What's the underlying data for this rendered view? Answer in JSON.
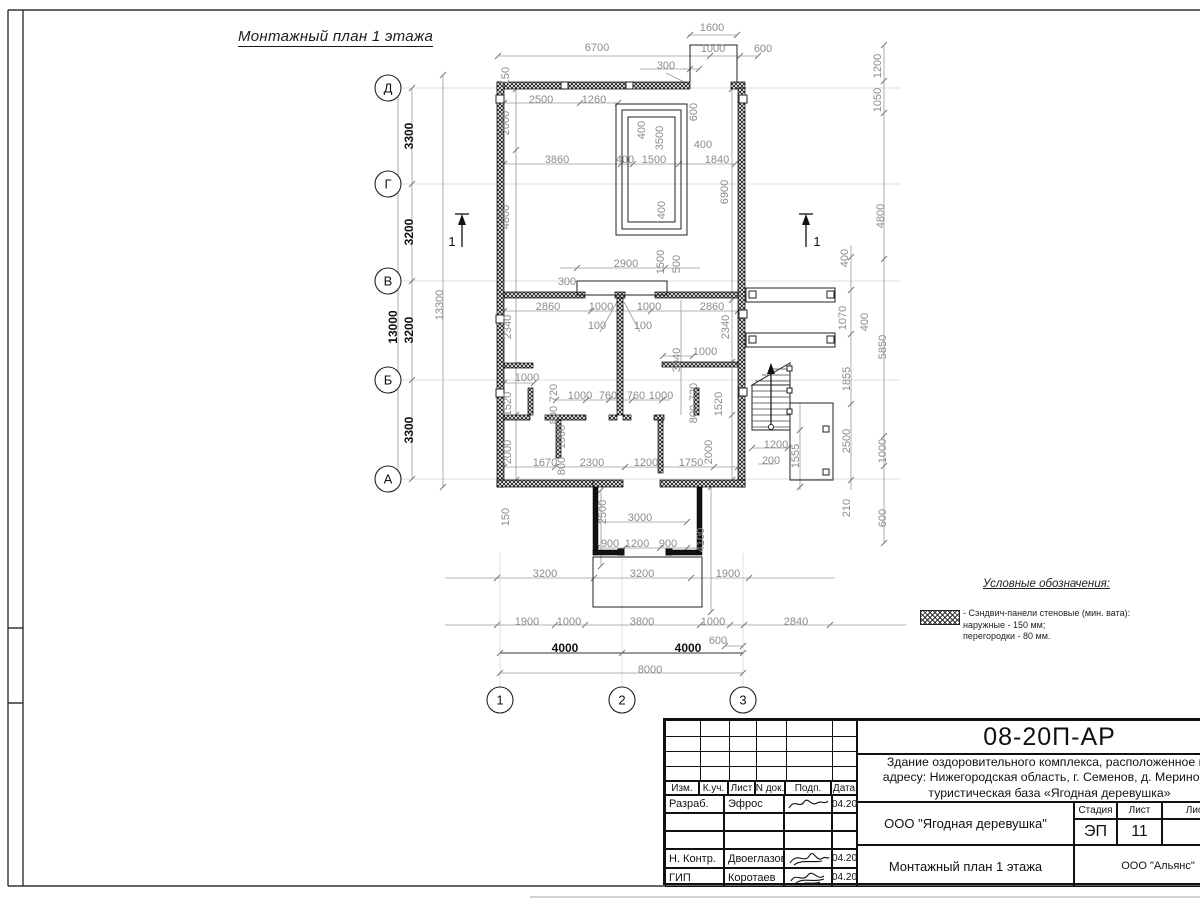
{
  "sheet": {
    "title": "Монтажный план 1 этажа"
  },
  "sections": [
    {
      "label": "1"
    },
    {
      "label": "1"
    }
  ],
  "axes": {
    "rows": [
      {
        "label": "Д",
        "y": 88
      },
      {
        "label": "Г",
        "y": 184
      },
      {
        "label": "В",
        "y": 281
      },
      {
        "label": "Б",
        "y": 380
      },
      {
        "label": "А",
        "y": 479
      }
    ],
    "cols": [
      {
        "label": "1",
        "x": 500
      },
      {
        "label": "2",
        "x": 622
      },
      {
        "label": "3",
        "x": 743
      }
    ]
  },
  "dimensions": [
    {
      "t": "1600",
      "x": 712,
      "y": 31,
      "o": "h"
    },
    {
      "t": "6700",
      "x": 597,
      "y": 51,
      "o": "h"
    },
    {
      "t": "1000",
      "x": 713,
      "y": 52,
      "o": "h"
    },
    {
      "t": "600",
      "x": 763,
      "y": 52,
      "o": "h"
    },
    {
      "t": "300",
      "x": 666,
      "y": 69,
      "o": "h"
    },
    {
      "t": "150",
      "x": 509,
      "y": 76,
      "o": "v"
    },
    {
      "t": "2500",
      "x": 541,
      "y": 103,
      "o": "h"
    },
    {
      "t": "1260",
      "x": 594,
      "y": 103,
      "o": "h"
    },
    {
      "t": "2000",
      "x": 509,
      "y": 123,
      "o": "v"
    },
    {
      "t": "600",
      "x": 697,
      "y": 112,
      "o": "v"
    },
    {
      "t": "400",
      "x": 645,
      "y": 130,
      "o": "v"
    },
    {
      "t": "3500",
      "x": 663,
      "y": 138,
      "o": "v"
    },
    {
      "t": "3860",
      "x": 557,
      "y": 163,
      "o": "h"
    },
    {
      "t": "400",
      "x": 625,
      "y": 163,
      "o": "h"
    },
    {
      "t": "1500",
      "x": 654,
      "y": 163,
      "o": "h"
    },
    {
      "t": "400",
      "x": 703,
      "y": 148,
      "o": "h"
    },
    {
      "t": "1840",
      "x": 717,
      "y": 163,
      "o": "h"
    },
    {
      "t": "6900",
      "x": 728,
      "y": 192,
      "o": "v"
    },
    {
      "t": "4800",
      "x": 509,
      "y": 217,
      "o": "v"
    },
    {
      "t": "400",
      "x": 665,
      "y": 210,
      "o": "v"
    },
    {
      "t": "1200",
      "x": 881,
      "y": 66,
      "o": "v"
    },
    {
      "t": "1050",
      "x": 881,
      "y": 100,
      "o": "v"
    },
    {
      "t": "4800",
      "x": 884,
      "y": 216,
      "o": "v"
    },
    {
      "t": "2900",
      "x": 626,
      "y": 267,
      "o": "h"
    },
    {
      "t": "300",
      "x": 567,
      "y": 285,
      "o": "h"
    },
    {
      "t": "1500",
      "x": 664,
      "y": 262,
      "o": "v"
    },
    {
      "t": "500",
      "x": 680,
      "y": 264,
      "o": "v"
    },
    {
      "t": "2860",
      "x": 548,
      "y": 310,
      "o": "h"
    },
    {
      "t": "1000",
      "x": 601,
      "y": 310,
      "o": "h"
    },
    {
      "t": "1000",
      "x": 649,
      "y": 310,
      "o": "h"
    },
    {
      "t": "2860",
      "x": 712,
      "y": 310,
      "o": "h"
    },
    {
      "t": "100",
      "x": 597,
      "y": 329,
      "o": "h"
    },
    {
      "t": "100",
      "x": 643,
      "y": 329,
      "o": "h"
    },
    {
      "t": "2340",
      "x": 511,
      "y": 327,
      "o": "v"
    },
    {
      "t": "2340",
      "x": 729,
      "y": 327,
      "o": "v"
    },
    {
      "t": "3940",
      "x": 680,
      "y": 360,
      "o": "v"
    },
    {
      "t": "1000",
      "x": 705,
      "y": 355,
      "o": "h"
    },
    {
      "t": "1000",
      "x": 527,
      "y": 381,
      "o": "h"
    },
    {
      "t": "400",
      "x": 848,
      "y": 258,
      "o": "v"
    },
    {
      "t": "1070",
      "x": 846,
      "y": 318,
      "o": "v"
    },
    {
      "t": "400",
      "x": 868,
      "y": 322,
      "o": "v"
    },
    {
      "t": "5850",
      "x": 886,
      "y": 347,
      "o": "v"
    },
    {
      "t": "1855",
      "x": 850,
      "y": 379,
      "o": "v"
    },
    {
      "t": "2500",
      "x": 850,
      "y": 441,
      "o": "v"
    },
    {
      "t": "1000",
      "x": 886,
      "y": 451,
      "o": "v"
    },
    {
      "t": "210",
      "x": 850,
      "y": 508,
      "o": "v"
    },
    {
      "t": "600",
      "x": 886,
      "y": 518,
      "o": "v"
    },
    {
      "t": "1200",
      "x": 776,
      "y": 448,
      "o": "h"
    },
    {
      "t": "200",
      "x": 771,
      "y": 464,
      "o": "h"
    },
    {
      "t": "1555",
      "x": 799,
      "y": 456,
      "o": "v"
    },
    {
      "t": "1520",
      "x": 511,
      "y": 404,
      "o": "v"
    },
    {
      "t": "720",
      "x": 557,
      "y": 393,
      "o": "v"
    },
    {
      "t": "800",
      "x": 557,
      "y": 415,
      "o": "v"
    },
    {
      "t": "1000",
      "x": 565,
      "y": 437,
      "o": "v"
    },
    {
      "t": "800",
      "x": 565,
      "y": 466,
      "o": "v"
    },
    {
      "t": "2000",
      "x": 511,
      "y": 452,
      "o": "v"
    },
    {
      "t": "720",
      "x": 697,
      "y": 392,
      "o": "v"
    },
    {
      "t": "800",
      "x": 697,
      "y": 414,
      "o": "v"
    },
    {
      "t": "1520",
      "x": 722,
      "y": 404,
      "o": "v"
    },
    {
      "t": "2000",
      "x": 712,
      "y": 452,
      "o": "v"
    },
    {
      "t": "1000",
      "x": 580,
      "y": 399,
      "o": "h"
    },
    {
      "t": "760",
      "x": 608,
      "y": 399,
      "o": "h"
    },
    {
      "t": "760",
      "x": 636,
      "y": 399,
      "o": "h"
    },
    {
      "t": "1000",
      "x": 661,
      "y": 399,
      "o": "h"
    },
    {
      "t": "1670",
      "x": 545,
      "y": 466,
      "o": "h"
    },
    {
      "t": "2300",
      "x": 592,
      "y": 466,
      "o": "h"
    },
    {
      "t": "1200",
      "x": 646,
      "y": 466,
      "o": "h"
    },
    {
      "t": "1750",
      "x": 691,
      "y": 466,
      "o": "h"
    },
    {
      "t": "150",
      "x": 509,
      "y": 517,
      "o": "v"
    },
    {
      "t": "2500",
      "x": 606,
      "y": 512,
      "o": "v"
    },
    {
      "t": "3000",
      "x": 640,
      "y": 521,
      "o": "h"
    },
    {
      "t": "900",
      "x": 610,
      "y": 547,
      "o": "h"
    },
    {
      "t": "1200",
      "x": 637,
      "y": 547,
      "o": "h"
    },
    {
      "t": "900",
      "x": 668,
      "y": 547,
      "o": "h"
    },
    {
      "t": "4100",
      "x": 704,
      "y": 540,
      "o": "v"
    },
    {
      "t": "3200",
      "x": 545,
      "y": 577,
      "o": "h"
    },
    {
      "t": "3200",
      "x": 642,
      "y": 577,
      "o": "h"
    },
    {
      "t": "1900",
      "x": 728,
      "y": 577,
      "o": "h"
    },
    {
      "t": "1900",
      "x": 527,
      "y": 625,
      "o": "h"
    },
    {
      "t": "1000",
      "x": 569,
      "y": 625,
      "o": "h"
    },
    {
      "t": "3800",
      "x": 642,
      "y": 625,
      "o": "h"
    },
    {
      "t": "1000",
      "x": 713,
      "y": 625,
      "o": "h"
    },
    {
      "t": "600",
      "x": 718,
      "y": 644,
      "o": "h"
    },
    {
      "t": "2840",
      "x": 796,
      "y": 625,
      "o": "h"
    },
    {
      "t": "4000",
      "x": 565,
      "y": 652,
      "o": "h",
      "d": 1
    },
    {
      "t": "4000",
      "x": 688,
      "y": 652,
      "o": "h",
      "d": 1
    },
    {
      "t": "8000",
      "x": 650,
      "y": 673,
      "o": "h"
    },
    {
      "t": "3300",
      "x": 413,
      "y": 136,
      "o": "v",
      "d": 1
    },
    {
      "t": "3200",
      "x": 413,
      "y": 232,
      "o": "v",
      "d": 1
    },
    {
      "t": "3200",
      "x": 413,
      "y": 330,
      "o": "v",
      "d": 1
    },
    {
      "t": "3300",
      "x": 413,
      "y": 430,
      "o": "v",
      "d": 1
    },
    {
      "t": "13000",
      "x": 397,
      "y": 327,
      "o": "v",
      "d": 1
    },
    {
      "t": "13300",
      "x": 443,
      "y": 305,
      "o": "v"
    }
  ],
  "legend": {
    "heading": "Условные обозначения:",
    "item_line1": "- Сэндвич-панели стеновые (мин. вата):",
    "item_line2": "наружные - 150 мм;",
    "item_line3": "перегородки - 80 мм."
  },
  "titleblock": {
    "doc_number": "08-20П-АР",
    "project_line1": "Здание оздоровительного комплекса, расположенное по",
    "project_line2": "адресу: Нижегородская область, г. Семенов, д. Мериново,",
    "project_line3": "туристическая база «Ягодная деревушка»",
    "columns": {
      "izm": "Изм.",
      "kuch": "К.уч.",
      "list": "Лист",
      "ndok": "N док.",
      "podp": "Подп.",
      "data": "Дата"
    },
    "rows": [
      {
        "role": "Разраб.",
        "name": "Эфрос",
        "date": "04.20"
      },
      {
        "role": "",
        "name": "",
        "date": ""
      },
      {
        "role": "",
        "name": "",
        "date": ""
      },
      {
        "role": "Н. Контр.",
        "name": "Двоеглазов",
        "date": "04.20"
      },
      {
        "role": "ГИП",
        "name": "Коротаев",
        "date": "04.20"
      }
    ],
    "org": "ООО \"Ягодная деревушка\"",
    "drawing_title": "Монтажный план 1 этажа",
    "stage_label": "Стадия",
    "sheet_label": "Лист",
    "sheets_label": "Листов",
    "stage": "ЭП",
    "sheet_no": "11",
    "sheets_total": "",
    "contractor": "ООО \"Альянс\""
  }
}
